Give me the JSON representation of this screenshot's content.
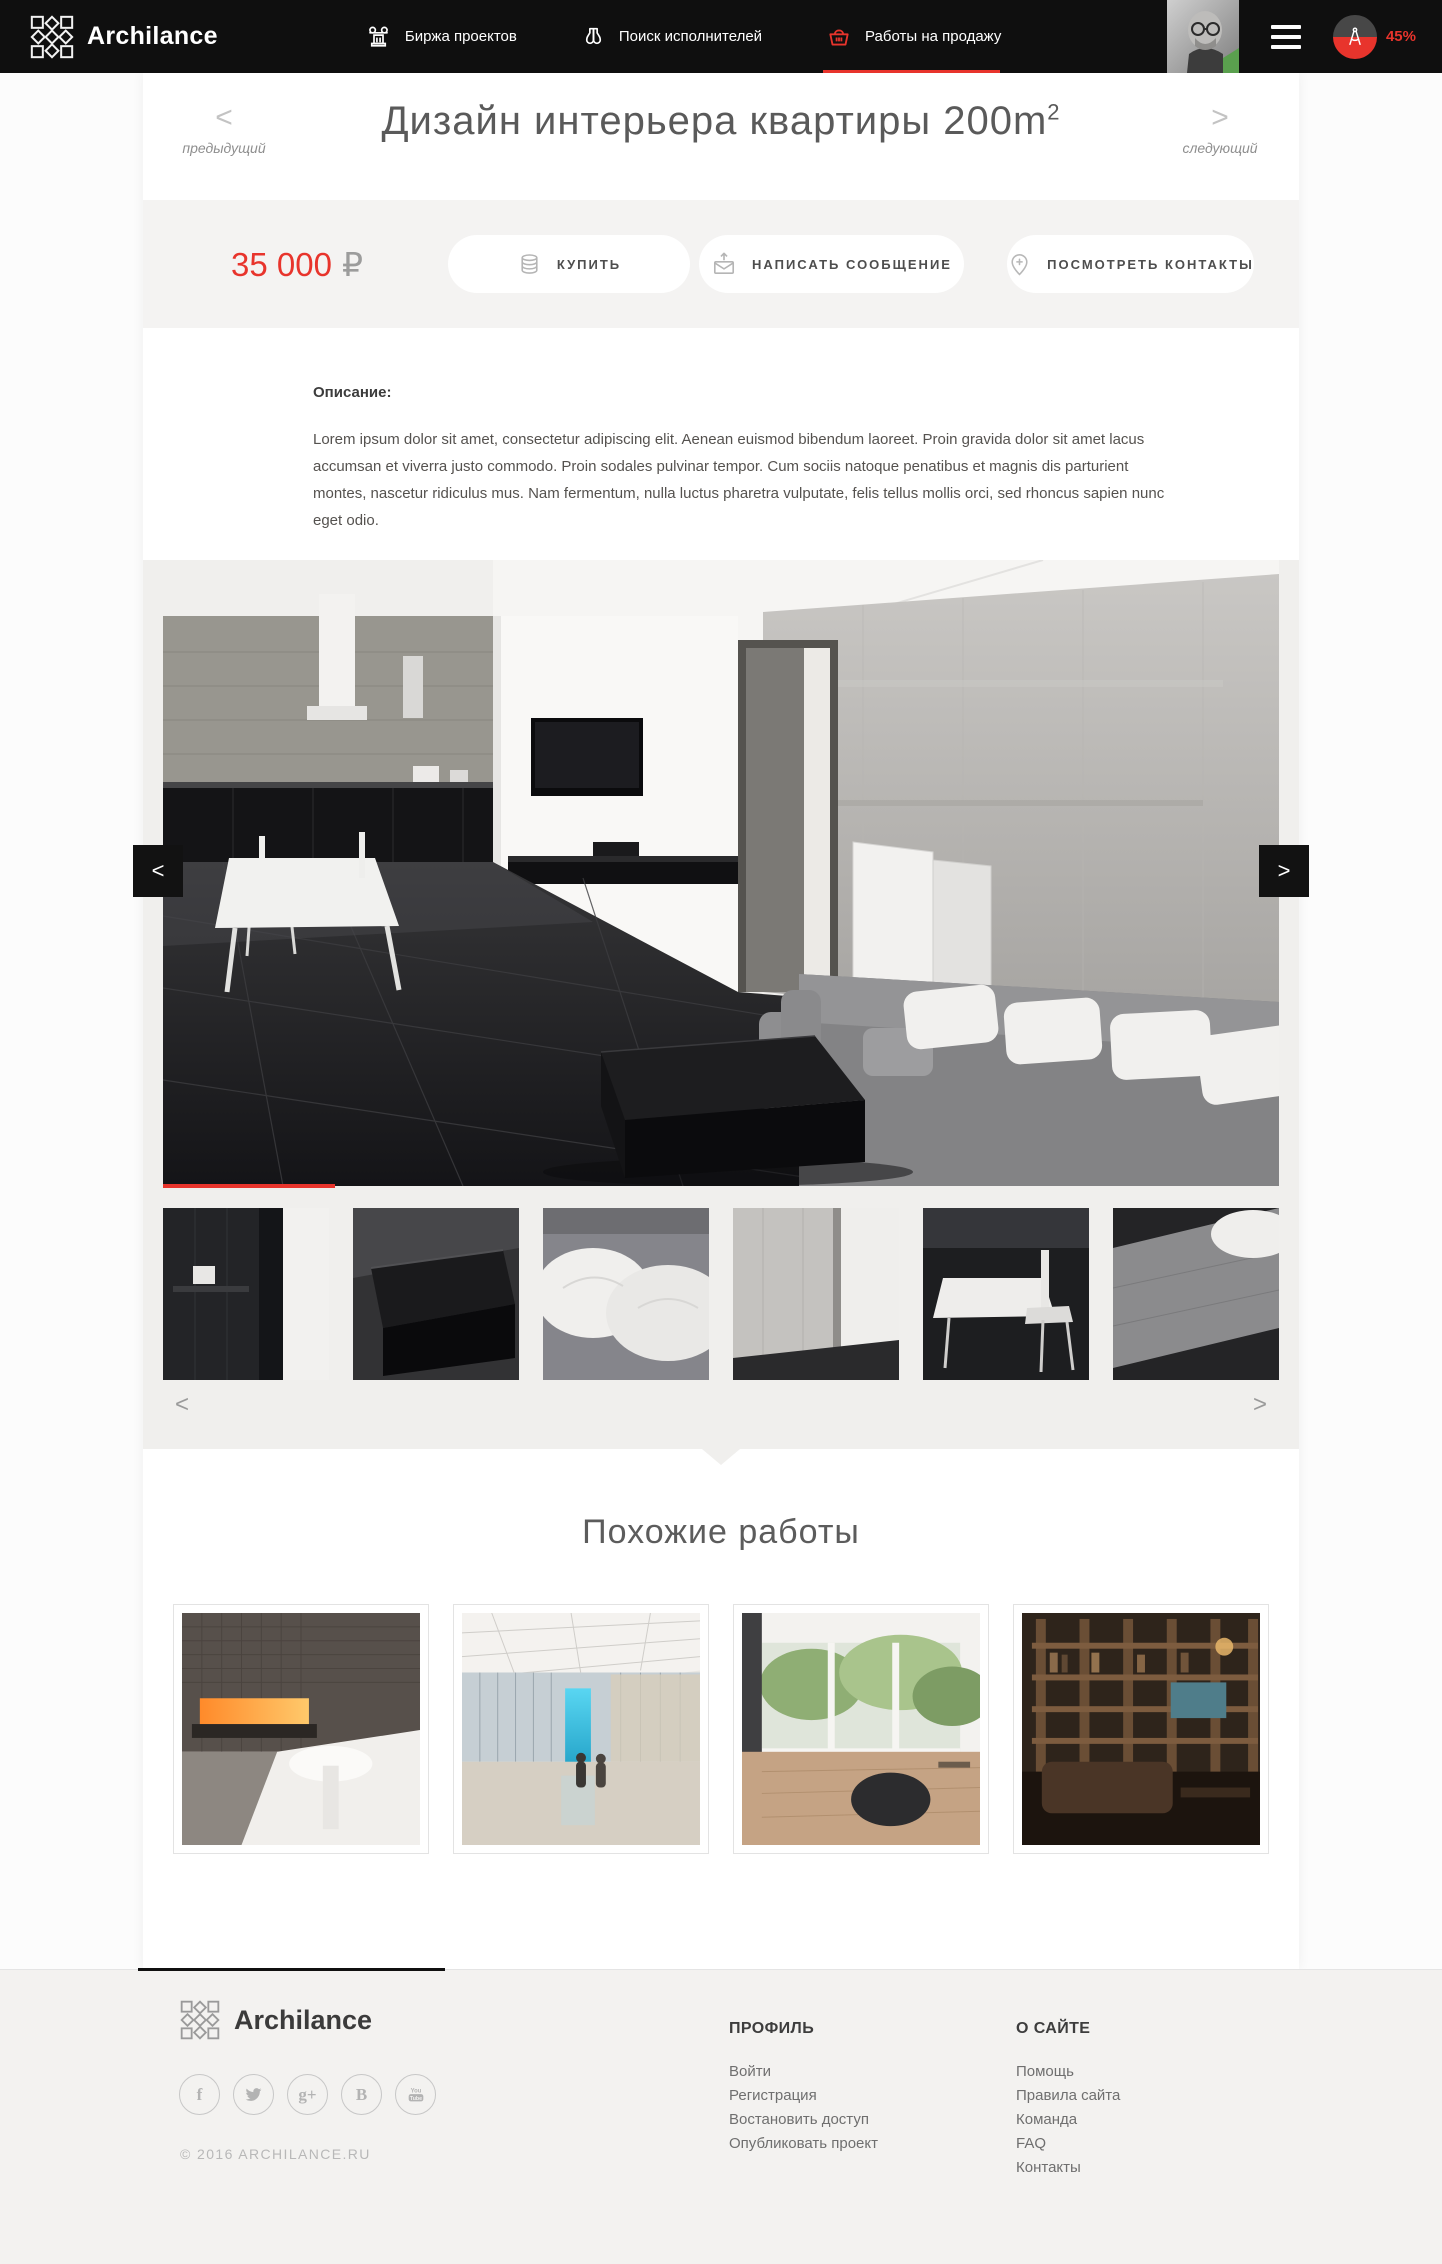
{
  "colors": {
    "accent": "#e8342c",
    "header_bg": "#0f0f0f",
    "section_grey": "#f0efed",
    "footer_bg": "#f3f2f0"
  },
  "header": {
    "brand": "Archilance",
    "nav": [
      {
        "label": "Биржа проектов",
        "icon": "column-icon"
      },
      {
        "label": "Поиск исполнителей",
        "icon": "binoculars-icon"
      },
      {
        "label": "Работы на продажу",
        "icon": "basket-icon",
        "active": true
      }
    ],
    "profile_completeness": "45%"
  },
  "pager": {
    "prev_arrow": "<",
    "prev_label": "предыдущий",
    "next_arrow": ">",
    "next_label": "следующий"
  },
  "page": {
    "title": "Дизайн интерьера квартиры 200m",
    "title_sup": "2"
  },
  "purchase": {
    "price": "35 000",
    "currency": "₽",
    "buttons": [
      {
        "label": "КУПИТЬ",
        "icon": "coins-icon"
      },
      {
        "label": "НАПИСАТЬ СООБЩЕНИЕ",
        "icon": "envelope-icon"
      },
      {
        "label": "ПОСМОТРЕТЬ КОНТАКТЫ",
        "icon": "map-pin-icon"
      }
    ]
  },
  "description": {
    "heading": "Описание:",
    "text": "Lorem ipsum dolor sit amet, consectetur adipiscing elit. Aenean euismod bibendum laoreet. Proin gravida dolor sit amet lacus accumsan et viverra justo commodo. Proin sodales pulvinar tempor. Cum sociis natoque penatibus et magnis dis parturient montes, nascetur ridiculus mus. Nam fermentum, nulla luctus pharetra vulputate, felis tellus mollis orci, sed rhoncus sapien nunc eget odio."
  },
  "gallery": {
    "prev_arrow": "<",
    "next_arrow": ">",
    "thumb_prev_arrow": "<",
    "thumb_next_arrow": ">",
    "thumbnail_count": 6,
    "active_thumbnail": 1
  },
  "similar": {
    "heading": "Похожие работы",
    "card_count": 4
  },
  "footer": {
    "brand": "Archilance",
    "copyright": "© 2016 ARCHILANCE.RU",
    "social": [
      {
        "name": "facebook",
        "glyph": "f"
      },
      {
        "name": "twitter"
      },
      {
        "name": "google-plus",
        "glyph": "g+"
      },
      {
        "name": "vk",
        "glyph": "B"
      },
      {
        "name": "youtube"
      }
    ],
    "columns": [
      {
        "heading": "ПРОФИЛЬ",
        "links": [
          "Войти",
          "Регистрация",
          "Востановить доступ",
          "Опубликовать проект"
        ]
      },
      {
        "heading": "О САЙТЕ",
        "links": [
          "Помощь",
          "Правила сайта",
          "Команда",
          "FAQ",
          "Контакты"
        ]
      }
    ]
  }
}
